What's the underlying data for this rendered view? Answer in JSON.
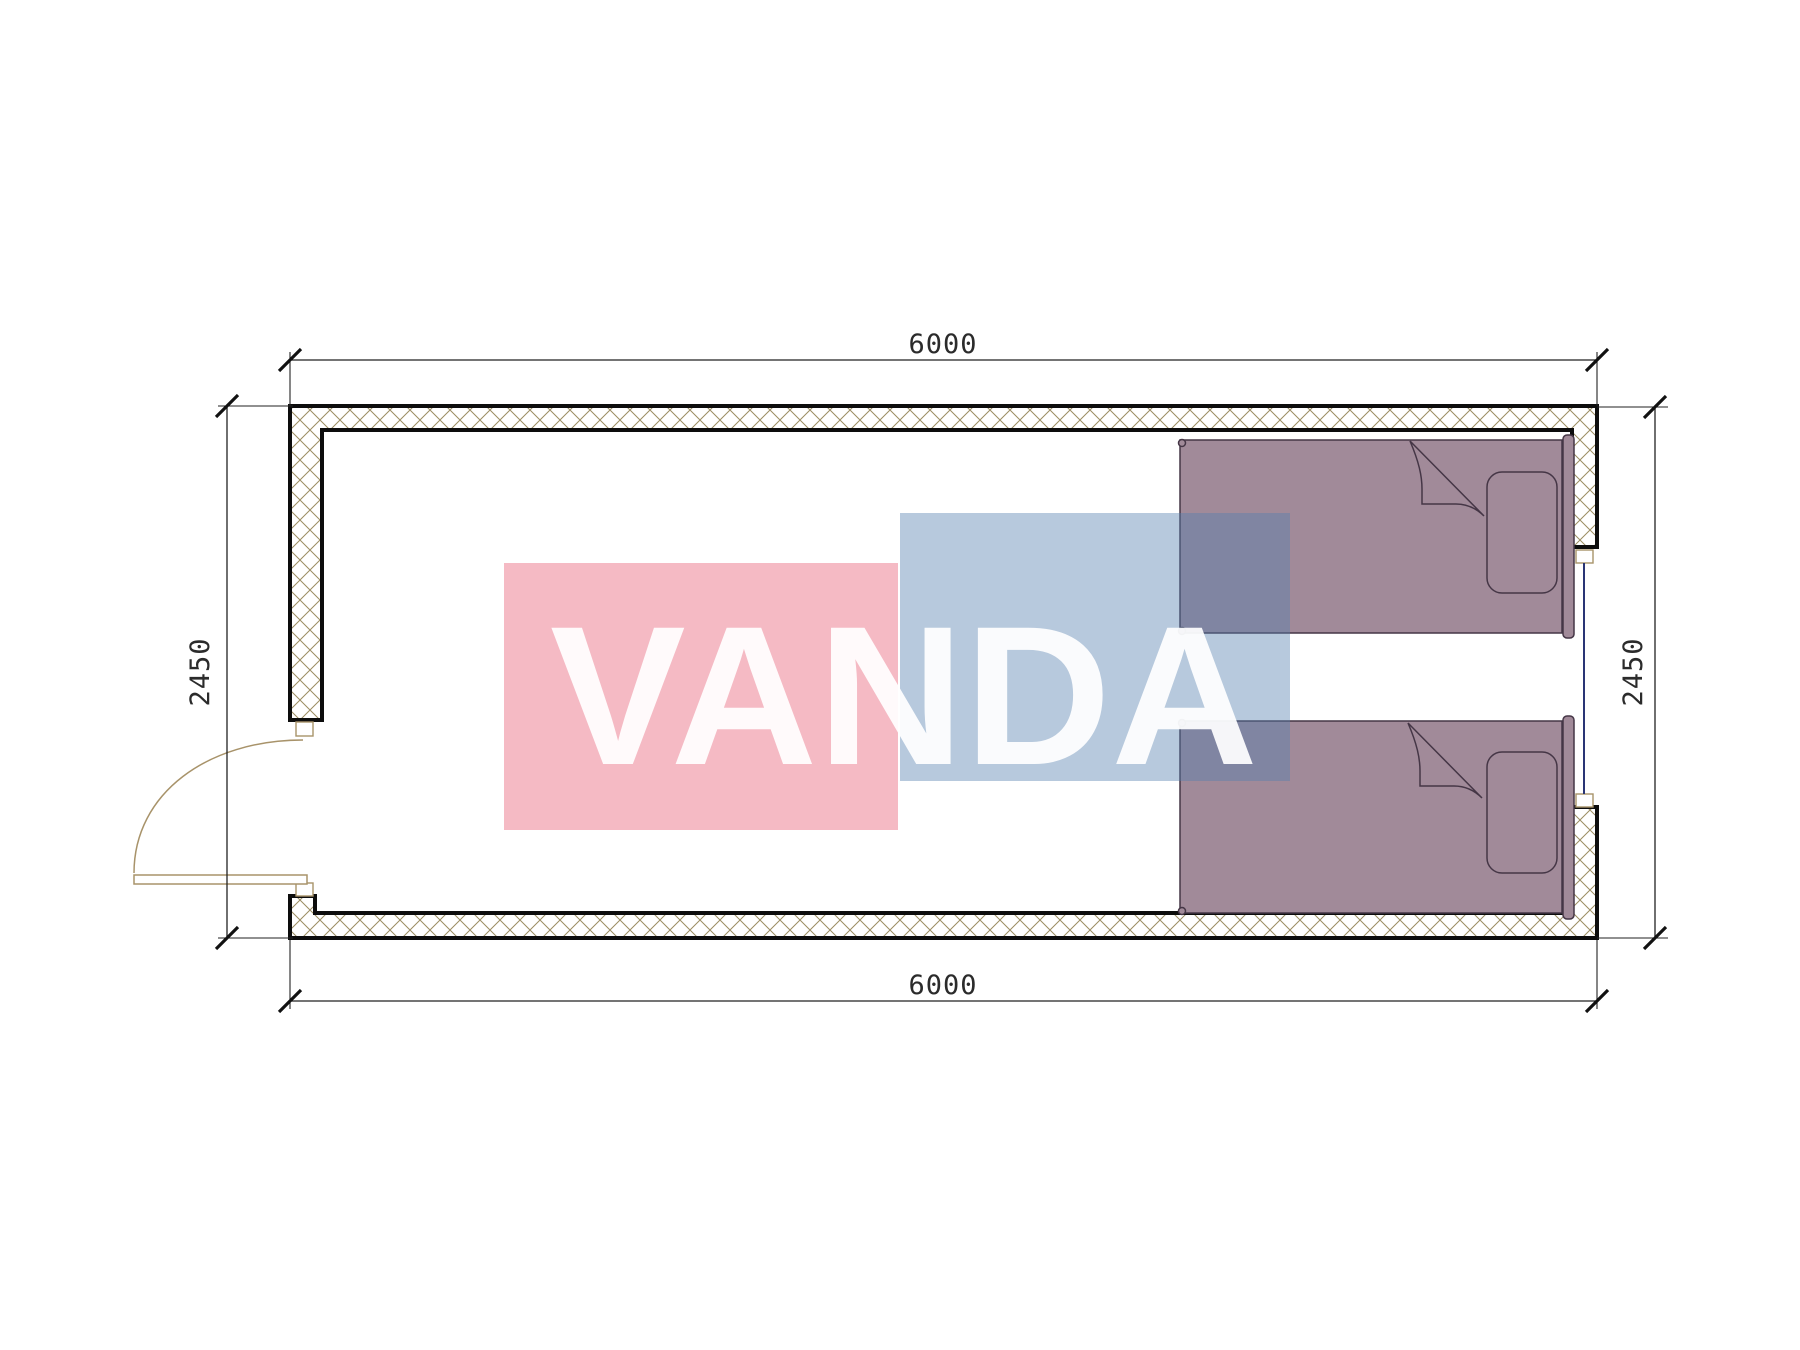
{
  "drawing": {
    "type": "floor-plan",
    "unit": "mm",
    "dimensions": {
      "top": "6000",
      "bottom": "6000",
      "left": "2450",
      "right": "2450"
    },
    "watermark": {
      "text": "VANDA"
    },
    "colors": {
      "watermark_pink": "#E85A73",
      "watermark_blue": "#537FAD",
      "bed_fill": "#A18A99",
      "wall_hatch": "#9B8D62",
      "wall_outline": "#0D0D0D",
      "window_glass": "#2A3575",
      "door_frame": "#A8936A"
    }
  }
}
